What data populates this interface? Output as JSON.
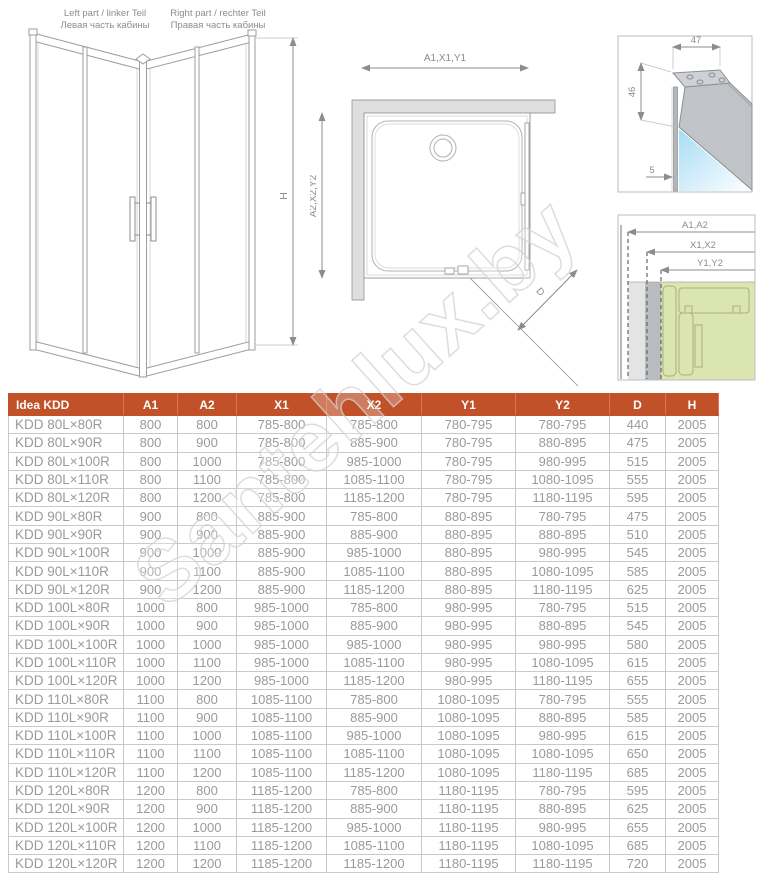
{
  "watermark": "Santehlux.by",
  "diagrams": {
    "cabin": {
      "caption_left_line1": "Left part / linker Teil",
      "caption_left_line2": "Левая часть кабины",
      "caption_right_line1": "Right part / rechter Teil",
      "caption_right_line2": "Правая часть кабины",
      "height_label": "H"
    },
    "plan": {
      "top_dim": "A1,X1,Y1",
      "left_dim": "A2,X2,Y2",
      "diag_dim": "D"
    },
    "profile_detail": {
      "dim_top": "47",
      "dim_left": "46",
      "dim_glass": "5"
    },
    "section_detail": {
      "dim1": "A1,A2",
      "dim2": "X1,X2",
      "dim3": "Y1,Y2"
    }
  },
  "table": {
    "headers": [
      "Idea KDD",
      "A1",
      "A2",
      "X1",
      "X2",
      "Y1",
      "Y2",
      "D",
      "H"
    ],
    "rows": [
      [
        "KDD 80L×80R",
        "800",
        "800",
        "785-800",
        "785-800",
        "780-795",
        "780-795",
        "440",
        "2005"
      ],
      [
        "KDD 80L×90R",
        "800",
        "900",
        "785-800",
        "885-900",
        "780-795",
        "880-895",
        "475",
        "2005"
      ],
      [
        "KDD 80L×100R",
        "800",
        "1000",
        "785-800",
        "985-1000",
        "780-795",
        "980-995",
        "515",
        "2005"
      ],
      [
        "KDD 80L×110R",
        "800",
        "1100",
        "785-800",
        "1085-1100",
        "780-795",
        "1080-1095",
        "555",
        "2005"
      ],
      [
        "KDD 80L×120R",
        "800",
        "1200",
        "785-800",
        "1185-1200",
        "780-795",
        "1180-1195",
        "595",
        "2005"
      ],
      [
        "KDD 90L×80R",
        "900",
        "800",
        "885-900",
        "785-800",
        "880-895",
        "780-795",
        "475",
        "2005"
      ],
      [
        "KDD 90L×90R",
        "900",
        "900",
        "885-900",
        "885-900",
        "880-895",
        "880-895",
        "510",
        "2005"
      ],
      [
        "KDD 90L×100R",
        "900",
        "1000",
        "885-900",
        "985-1000",
        "880-895",
        "980-995",
        "545",
        "2005"
      ],
      [
        "KDD 90L×110R",
        "900",
        "1100",
        "885-900",
        "1085-1100",
        "880-895",
        "1080-1095",
        "585",
        "2005"
      ],
      [
        "KDD 90L×120R",
        "900",
        "1200",
        "885-900",
        "1185-1200",
        "880-895",
        "1180-1195",
        "625",
        "2005"
      ],
      [
        "KDD 100L×80R",
        "1000",
        "800",
        "985-1000",
        "785-800",
        "980-995",
        "780-795",
        "515",
        "2005"
      ],
      [
        "KDD 100L×90R",
        "1000",
        "900",
        "985-1000",
        "885-900",
        "980-995",
        "880-895",
        "545",
        "2005"
      ],
      [
        "KDD 100L×100R",
        "1000",
        "1000",
        "985-1000",
        "985-1000",
        "980-995",
        "980-995",
        "580",
        "2005"
      ],
      [
        "KDD 100L×110R",
        "1000",
        "1100",
        "985-1000",
        "1085-1100",
        "980-995",
        "1080-1095",
        "615",
        "2005"
      ],
      [
        "KDD 100L×120R",
        "1000",
        "1200",
        "985-1000",
        "1185-1200",
        "980-995",
        "1180-1195",
        "655",
        "2005"
      ],
      [
        "KDD 110L×80R",
        "1100",
        "800",
        "1085-1100",
        "785-800",
        "1080-1095",
        "780-795",
        "555",
        "2005"
      ],
      [
        "KDD 110L×90R",
        "1100",
        "900",
        "1085-1100",
        "885-900",
        "1080-1095",
        "880-895",
        "585",
        "2005"
      ],
      [
        "KDD 110L×100R",
        "1100",
        "1000",
        "1085-1100",
        "985-1000",
        "1080-1095",
        "980-995",
        "615",
        "2005"
      ],
      [
        "KDD 110L×110R",
        "1100",
        "1100",
        "1085-1100",
        "1085-1100",
        "1080-1095",
        "1080-1095",
        "650",
        "2005"
      ],
      [
        "KDD 110L×120R",
        "1100",
        "1200",
        "1085-1100",
        "1185-1200",
        "1080-1095",
        "1180-1195",
        "685",
        "2005"
      ],
      [
        "KDD 120L×80R",
        "1200",
        "800",
        "1185-1200",
        "785-800",
        "1180-1195",
        "780-795",
        "595",
        "2005"
      ],
      [
        "KDD 120L×90R",
        "1200",
        "900",
        "1185-1200",
        "885-900",
        "1180-1195",
        "880-895",
        "625",
        "2005"
      ],
      [
        "KDD 120L×100R",
        "1200",
        "1000",
        "1185-1200",
        "985-1000",
        "1180-1195",
        "980-995",
        "655",
        "2005"
      ],
      [
        "KDD 120L×110R",
        "1200",
        "1100",
        "1185-1200",
        "1085-1100",
        "1180-1195",
        "1080-1095",
        "685",
        "2005"
      ],
      [
        "KDD 120L×120R",
        "1200",
        "1200",
        "1185-1200",
        "1185-1200",
        "1180-1195",
        "1180-1195",
        "720",
        "2005"
      ]
    ]
  },
  "colors": {
    "header_bg": "#c05129",
    "header_text": "#ffffff",
    "cell_text": "#9a9a9a",
    "table_border": "#c9c9c9",
    "drawing_line": "#9e9e9e",
    "glass_blue": "#a6dcf5",
    "profile_green": "#dbe5af",
    "wall_gray": "#dedede"
  }
}
